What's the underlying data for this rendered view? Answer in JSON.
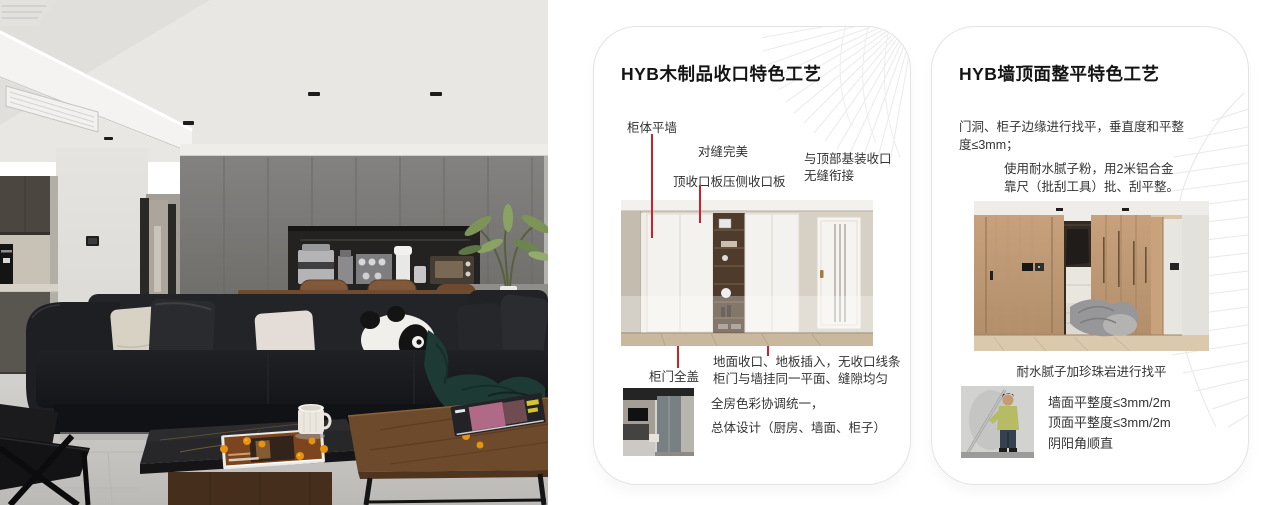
{
  "accent": {
    "callout_red": "#c5232d"
  },
  "cards": [
    {
      "title": "HYB木制品收口特色工艺",
      "callouts": {
        "cabinet_wall": "柜体平墙",
        "seam": "对缝完美",
        "top_panel": "顶收口板压侧收口板",
        "top_joint": [
          "与顶部基装收口",
          "无缝衔接"
        ],
        "door_cover": "柜门全盖",
        "floor_joint": [
          "地面收口、地板插入，无收口线条",
          "柜门与墙挂同一平面、缝隙均匀"
        ]
      },
      "summary": [
        "全房色彩协调统一，",
        "总体设计（厨房、墙面、柜子）"
      ]
    },
    {
      "title": "HYB墙顶面整平特色工艺",
      "para1": [
        "门洞、柜子边缘进行找平，垂直度和平整",
        "度≤3mm；"
      ],
      "para2": [
        "使用耐水腻子粉，用2米铝合金",
        "靠尺（批刮工具）批、刮平整。"
      ],
      "caption": "耐水腻子加珍珠岩进行找平",
      "bullets": [
        "墙面平整度≤3mm/2m",
        "顶面平整度≤3mm/2m",
        "阴阳角顺直"
      ]
    }
  ]
}
